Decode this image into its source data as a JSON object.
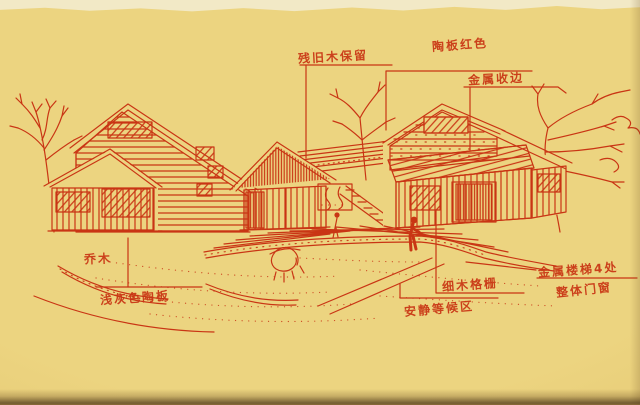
{
  "palette": {
    "paper": "#ecd480",
    "paper_light": "#f2e9c6",
    "paper_shadow": "#d4b25c",
    "edge_dark": "#6e5126",
    "ink": "#c93514"
  },
  "annotations": [
    {
      "id": "old-wood",
      "text": "残旧木保留"
    },
    {
      "id": "terracotta-red",
      "text": "陶板红色"
    },
    {
      "id": "metal-trim",
      "text": "金属收边"
    },
    {
      "id": "tree",
      "text": "乔木"
    },
    {
      "id": "grey-panel",
      "text": "浅灰色陶板"
    },
    {
      "id": "wood-grille",
      "text": "细木格栅"
    },
    {
      "id": "waiting-area",
      "text": "安静等候区"
    },
    {
      "id": "metal-stairs",
      "text": "金属楼梯4处"
    },
    {
      "id": "doors-windows",
      "text": "整体门窗"
    }
  ]
}
